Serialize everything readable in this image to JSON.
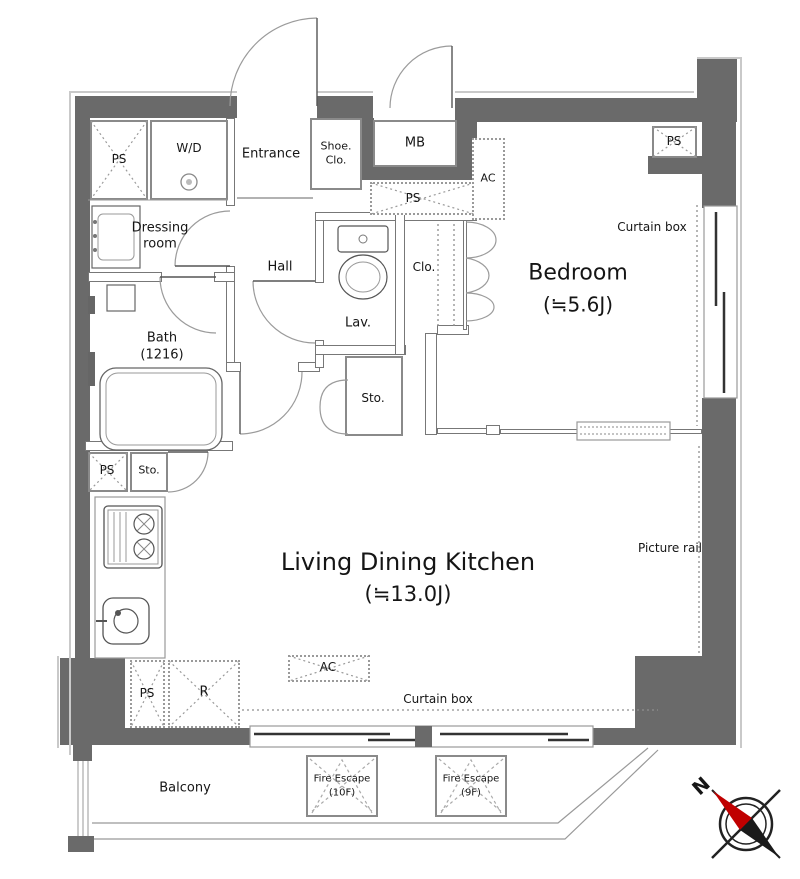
{
  "plan": {
    "rooms": {
      "bedroom": {
        "name": "Bedroom",
        "size": "(≒5.6J)"
      },
      "ldk": {
        "name": "Living Dining Kitchen",
        "size": "(≒13.0J)"
      },
      "bath": {
        "name": "Bath",
        "size": "(1216)"
      },
      "dressing": {
        "line1": "Dressing",
        "line2": "room"
      },
      "hall": "Hall",
      "lav": "Lav.",
      "entrance": "Entrance",
      "balcony": "Balcony"
    },
    "features": {
      "ps": "PS",
      "wd": "W/D",
      "shoe1": "Shoe.",
      "shoe2": "Clo.",
      "mb": "MB",
      "ac": "AC",
      "clo": "Clo.",
      "sto": "Sto.",
      "r": "R",
      "curtain_box": "Curtain box",
      "picture_rail": "Picture rail",
      "fire_escape": "Fire Escape",
      "floor_10f": "(10F)",
      "floor_9f": "(9F)"
    },
    "compass": {
      "north": "N"
    },
    "colors": {
      "wall": "#6a6a6a",
      "outline": "#c9c9c9",
      "needle_red": "#c00000"
    }
  }
}
